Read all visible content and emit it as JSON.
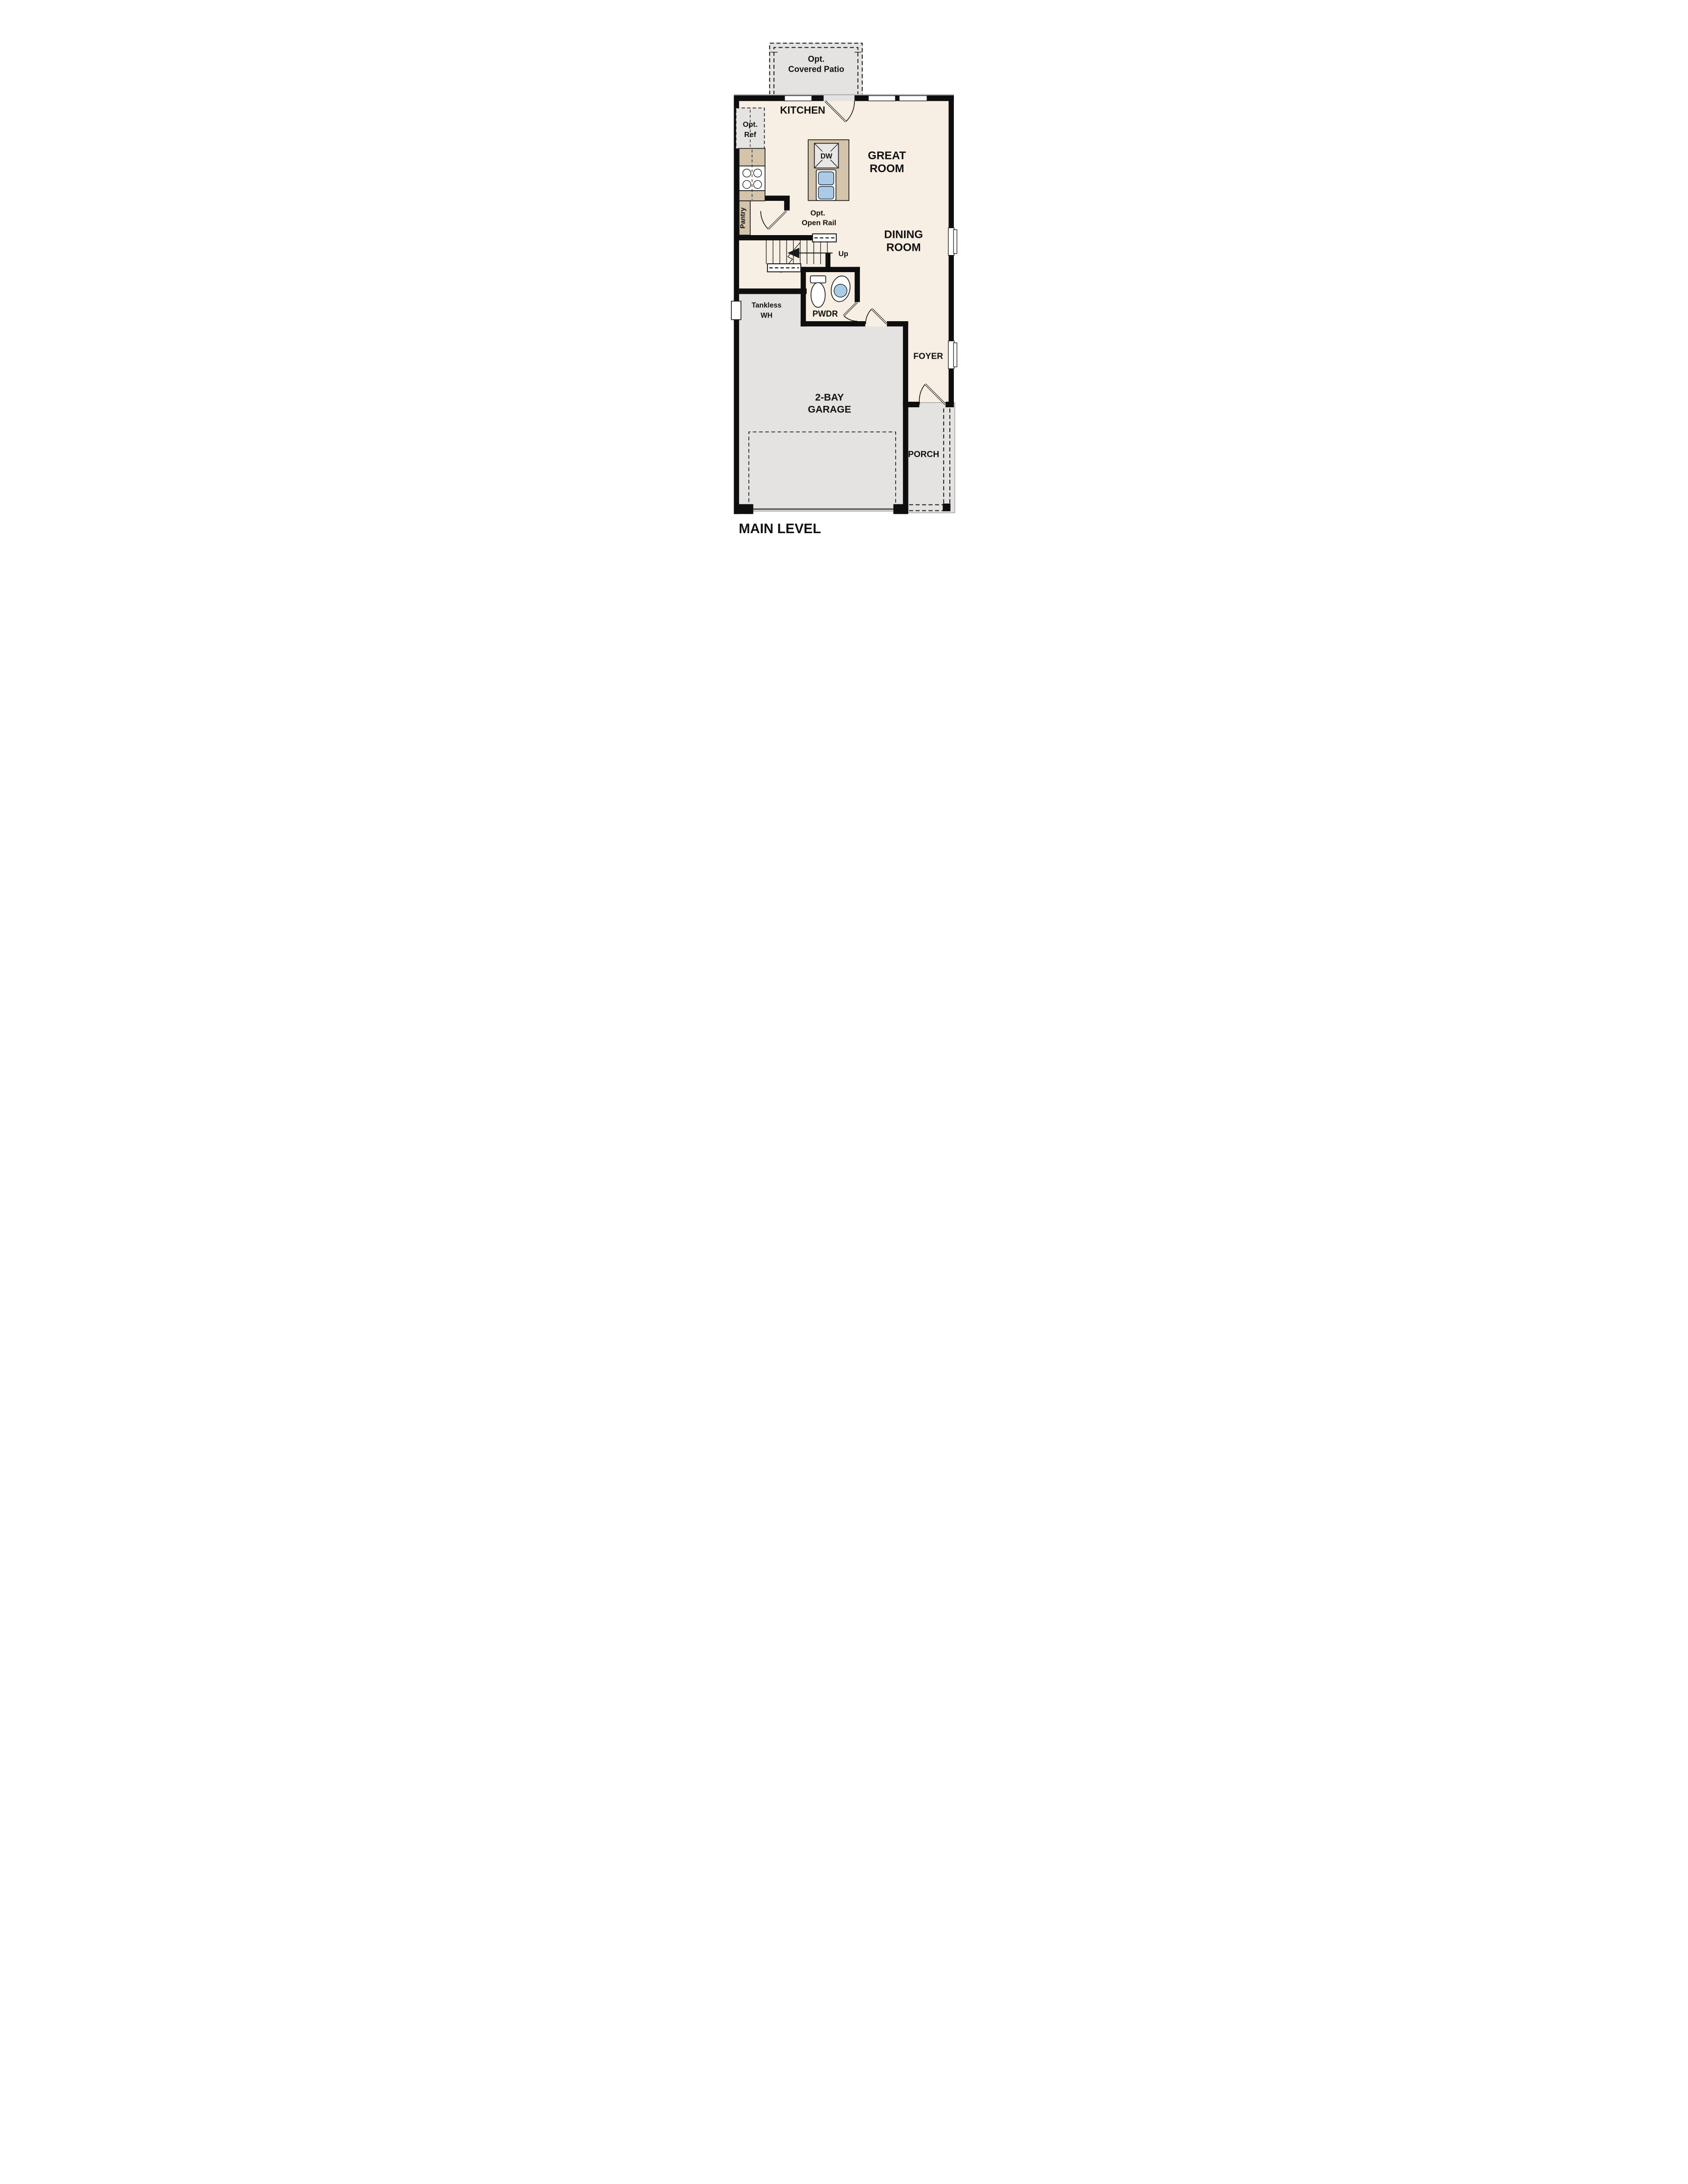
{
  "title": "MAIN LEVEL",
  "labels": {
    "patio_line1": "Opt.",
    "patio_line2": "Covered Patio",
    "kitchen": "KITCHEN",
    "opt_ref_line1": "Opt.",
    "opt_ref_line2": "Ref",
    "dw": "DW",
    "great_room_line1": "GREAT",
    "great_room_line2": "ROOM",
    "pantry": "Pantry",
    "open_rail_line1": "Opt.",
    "open_rail_line2": "Open Rail",
    "up": "Up",
    "dining_room_line1": "DINING",
    "dining_room_line2": "ROOM",
    "pwdr": "PWDR",
    "tankless_line1": "Tankless",
    "tankless_line2": "WH",
    "foyer": "FOYER",
    "garage_line1": "2-BAY",
    "garage_line2": "GARAGE",
    "porch": "PORCH",
    "main_level": "MAIN LEVEL"
  },
  "colors": {
    "floor": "#f7efe3",
    "concrete": "#e5e3e1",
    "casework": "#d3c4ab",
    "appliance": "#e9e7e5",
    "wall": "#0e0e0e",
    "fixture_blue": "#a9cbe7"
  }
}
